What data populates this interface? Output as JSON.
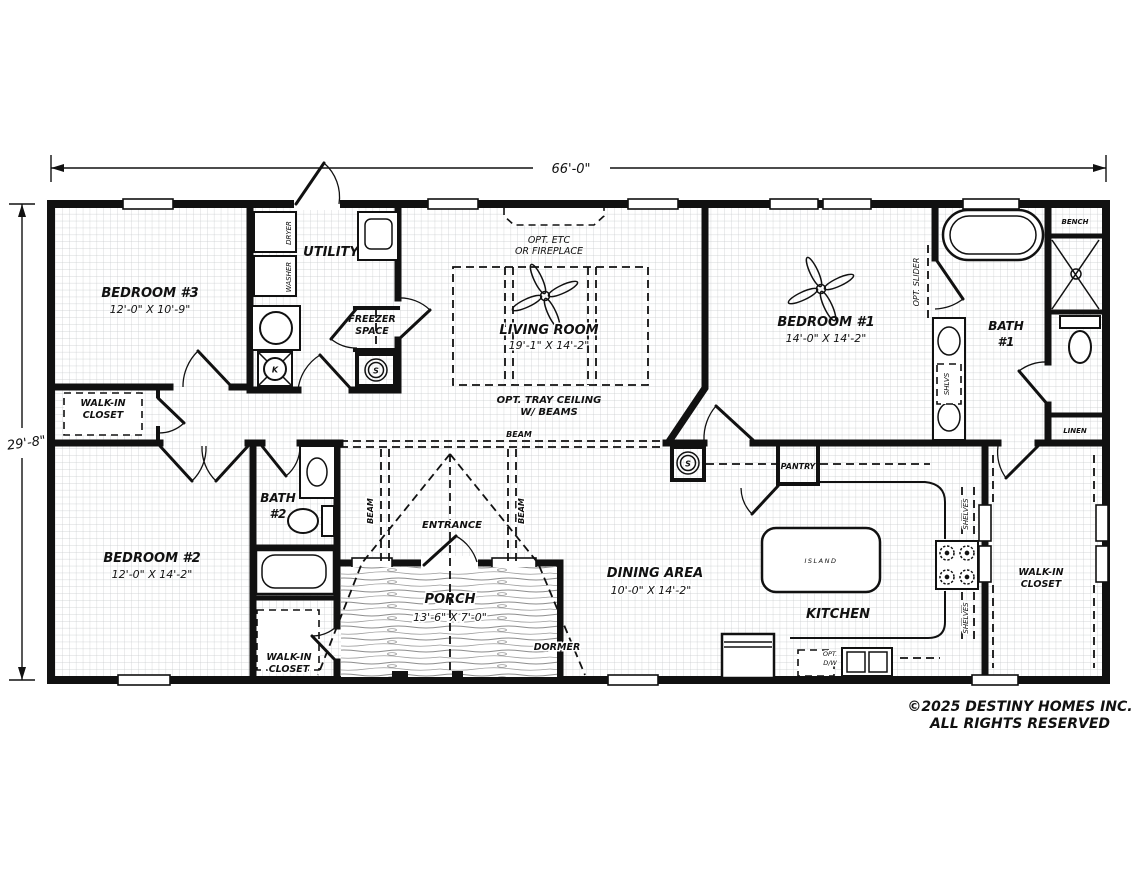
{
  "dimensions": {
    "width": "66'-0\"",
    "height": "29'-8\""
  },
  "rooms": {
    "bedroom1_name": "BEDROOM #1",
    "bedroom1_dims": "14'-0\" X 14'-2\"",
    "bedroom2_name": "BEDROOM #2",
    "bedroom2_dims": "12'-0\" X 14'-2\"",
    "bedroom3_name": "BEDROOM #3",
    "bedroom3_dims": "12'-0\" X 10'-9\"",
    "living_name": "LIVING ROOM",
    "living_dims": "19'-1\" X 14'-2\"",
    "dining_name": "DINING AREA",
    "dining_dims": "10'-0\" X 14'-2\"",
    "porch_name": "PORCH",
    "porch_dims": "13'-6\" X 7'-0\"",
    "kitchen_name": "KITCHEN",
    "utility_name": "UTILITY",
    "bath1_name": "BATH",
    "bath1_number": "#1",
    "bath2_name": "BATH",
    "bath2_number": "#2",
    "walkin_line1": "WALK-IN",
    "walkin_line2": "CLOSET"
  },
  "features": {
    "freezer_line1": "FREEZER",
    "freezer_line2": "SPACE",
    "opt_fireplace_line1": "OPT. ETC",
    "opt_fireplace_line2": "OR FIREPLACE",
    "tray_ceiling_line1": "OPT. TRAY CEILING",
    "tray_ceiling_line2": "W/ BEAMS",
    "beam": "BEAM",
    "entrance": "ENTRANCE",
    "dormer": "DORMER",
    "pantry": "PANTRY",
    "island": "ISLAND",
    "bench": "BENCH",
    "linen": "LINEN",
    "shelves": "SHELVES",
    "shlvs": "SHLVS",
    "opt_slider": "OPT. SLIDER",
    "dryer": "DRYER",
    "washer": "WASHER",
    "opt_dw_line1": "OPT.",
    "opt_dw_line2": "D/W",
    "smoke_detector": "S",
    "furnace": "K"
  },
  "footer": {
    "copyright_line1": "©2025 DESTINY HOMES INC.",
    "copyright_line2": "ALL RIGHTS RESERVED"
  },
  "colors": {
    "wall": "#111111",
    "grid": "#c7cacc",
    "background": "#ffffff"
  }
}
